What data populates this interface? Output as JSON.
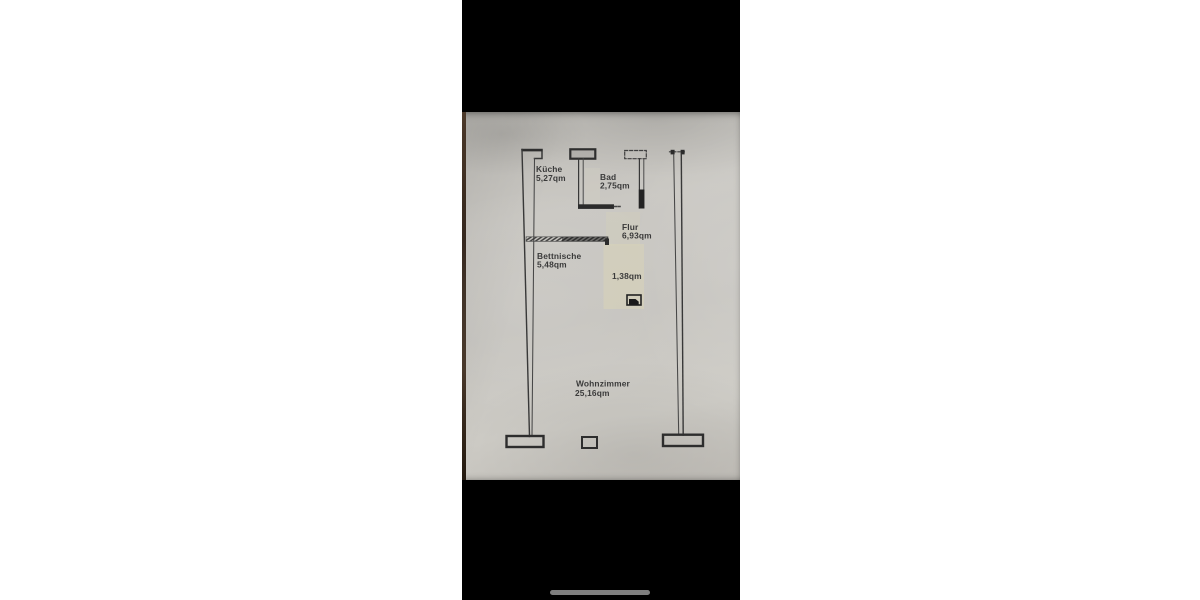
{
  "window": {
    "background_color": "#ffffff"
  },
  "phone": {
    "background_color": "#000000",
    "home_indicator_color": "#7f7f7f"
  },
  "photo": {
    "paper_color": "#c8c6c1",
    "table_edge_color": "#3a2b1e",
    "highlight_patch_color": "#d8d3b8"
  },
  "plan": {
    "ink_color": "#323232",
    "text_color": "#3a3a3a",
    "rooms": [
      {
        "name": "Küche",
        "area": "5,27qm"
      },
      {
        "name": "Bad",
        "area": "2,75qm"
      },
      {
        "name": "Flur",
        "area": "6,93qm"
      },
      {
        "name": "Bettnische",
        "area": "5,48qm"
      },
      {
        "area": "1,38qm"
      },
      {
        "name": "Wohnzimmer",
        "area": "25,16qm"
      }
    ]
  }
}
